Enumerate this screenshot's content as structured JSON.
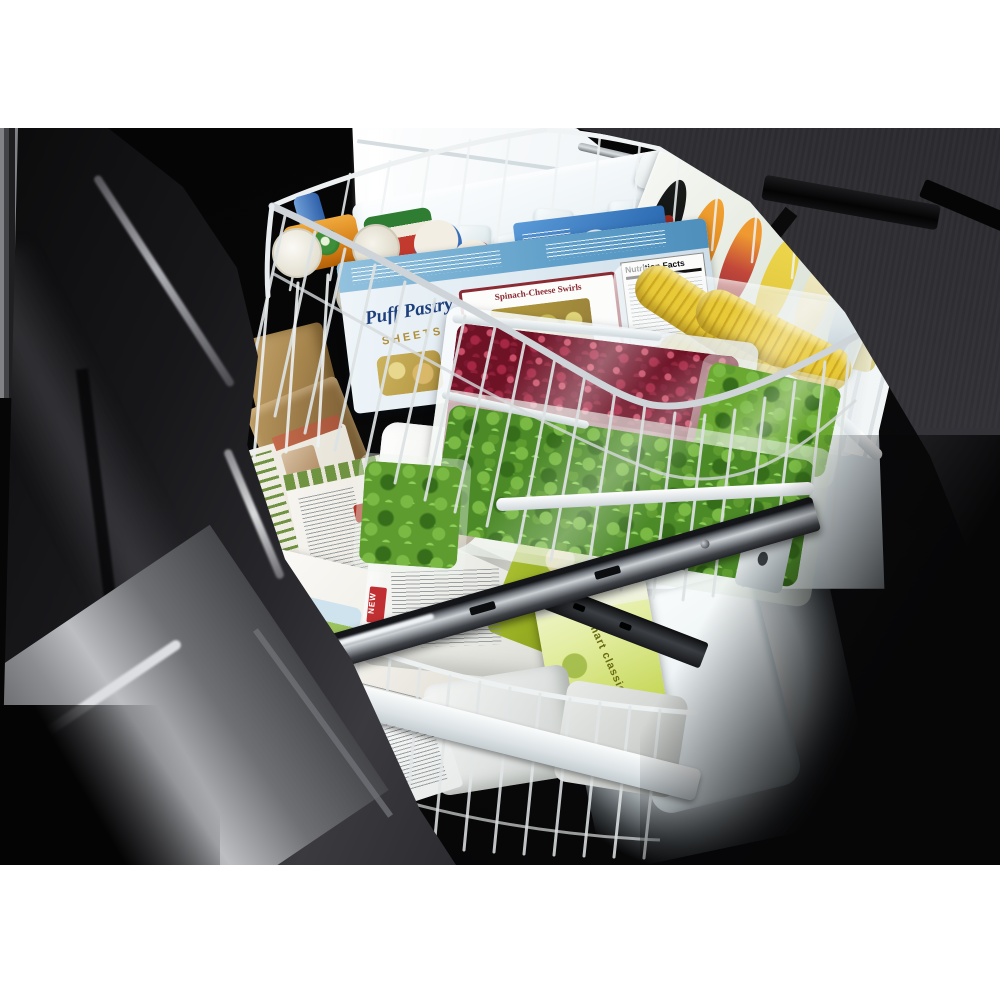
{
  "scene": {
    "type": "product-photograph",
    "description": "Stainless-steel bottom-freezer refrigerator with freezer drawer pulled fully open, viewed from above-left; interior light on; wire basket and drawer packed with frozen foods",
    "page_background": "#ffffff",
    "photo_background": "#060607",
    "photo_area": {
      "left": 0,
      "top": 128,
      "width": 1000,
      "height": 737
    }
  },
  "labels": {
    "puff_script": "Puff Pastry",
    "puff_sub": "SHEETS",
    "recipe_title": "Spinach-Cheese Swirls",
    "nutrition": "Nutrition Facts",
    "new_tag": "NEW",
    "smart": "smart classics",
    "amys": "Amy's",
    "bag_letters_top": "IA",
    "bag_letters": "ES"
  },
  "objects": [
    {
      "name": "refrigerator-door-left",
      "color": "#2e2e31",
      "finish": "dark brushed stainless, curved edge highlight"
    },
    {
      "name": "drawer-front-inner-panel",
      "color": "#232327",
      "position": "top-right",
      "detail": "black handle bracket"
    },
    {
      "name": "freezer-interior",
      "color": "#eef2f4",
      "detail": "illuminated white liner with ribbed wall"
    },
    {
      "name": "ice-bin",
      "color": "#eff4f6",
      "contents": "ice cubes",
      "cube_color": "#e8f0f2"
    },
    {
      "name": "wire-basket-upper",
      "color": "#e9edee",
      "contents": [
        "juice concentrate cans",
        "puff pastry box",
        "blue box",
        "red box",
        "berries freezer bag",
        "corn on the cob bag",
        "leafy greens bags",
        "yellow sticky tag"
      ]
    },
    {
      "name": "divider-organizer",
      "color": "#e8ece8",
      "detail": "oval cutouts showing orange, red, yellow packages"
    },
    {
      "name": "round-tubs",
      "colors": [
        "#e8920f",
        "#e9dd96"
      ]
    },
    {
      "name": "kraft-paper-packages",
      "color": "#a98a52"
    },
    {
      "name": "boxed-meals",
      "color": "#f2efe8",
      "detail": "white boxes, barcode, farm illustration, red script logo"
    },
    {
      "name": "fries-bag",
      "colors": [
        "#f0f0ec",
        "#96ad22",
        "#1c1c1c"
      ],
      "detail": "onion visible, NEW tag"
    },
    {
      "name": "smart-classics-bag",
      "color": "#cfe06a"
    },
    {
      "name": "drawer-rail-metal",
      "color": "#9aa0a6"
    },
    {
      "name": "floor-glow",
      "color": "#ffffff"
    }
  ]
}
